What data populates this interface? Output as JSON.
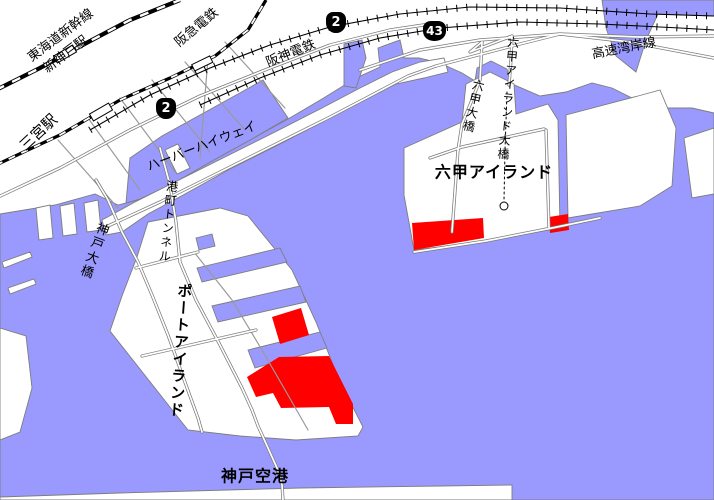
{
  "map": {
    "labels": {
      "tokaido_shinkansen": "東海道新幹線",
      "shin_kobe_station": "新神戸駅",
      "hankyu_railway": "阪急電鉄",
      "hanshin_railway": "阪神電鉄",
      "sannomiya_station": "三宮駅",
      "harbor_highway": "ハーバーハイウェイ",
      "minatomachi_tunnel": "港町トンネル",
      "kobe_ohashi_bridge": "神戸大橋",
      "port_island": "ポートアイランド",
      "kobe_airport": "神戸空港",
      "rokko_island": "六甲アイランド",
      "rokko_island_ohashi_bridge": "六甲アイランド大橋",
      "rokko_ohashi_bridge": "六甲大橋",
      "expressway_wangan_line": "高速湾岸線"
    },
    "badges": [
      {
        "number": "2"
      },
      {
        "number": "2"
      },
      {
        "number": "43"
      }
    ],
    "colors": {
      "water": "#9a9afe",
      "land": "#ffffff",
      "highlight_zone": "#ff0000",
      "coastline": "#7d7d7d",
      "road_casing": "#7a7a7a",
      "railway": "#000000",
      "badge_background": "#000000",
      "badge_number": "#ffffff"
    }
  }
}
